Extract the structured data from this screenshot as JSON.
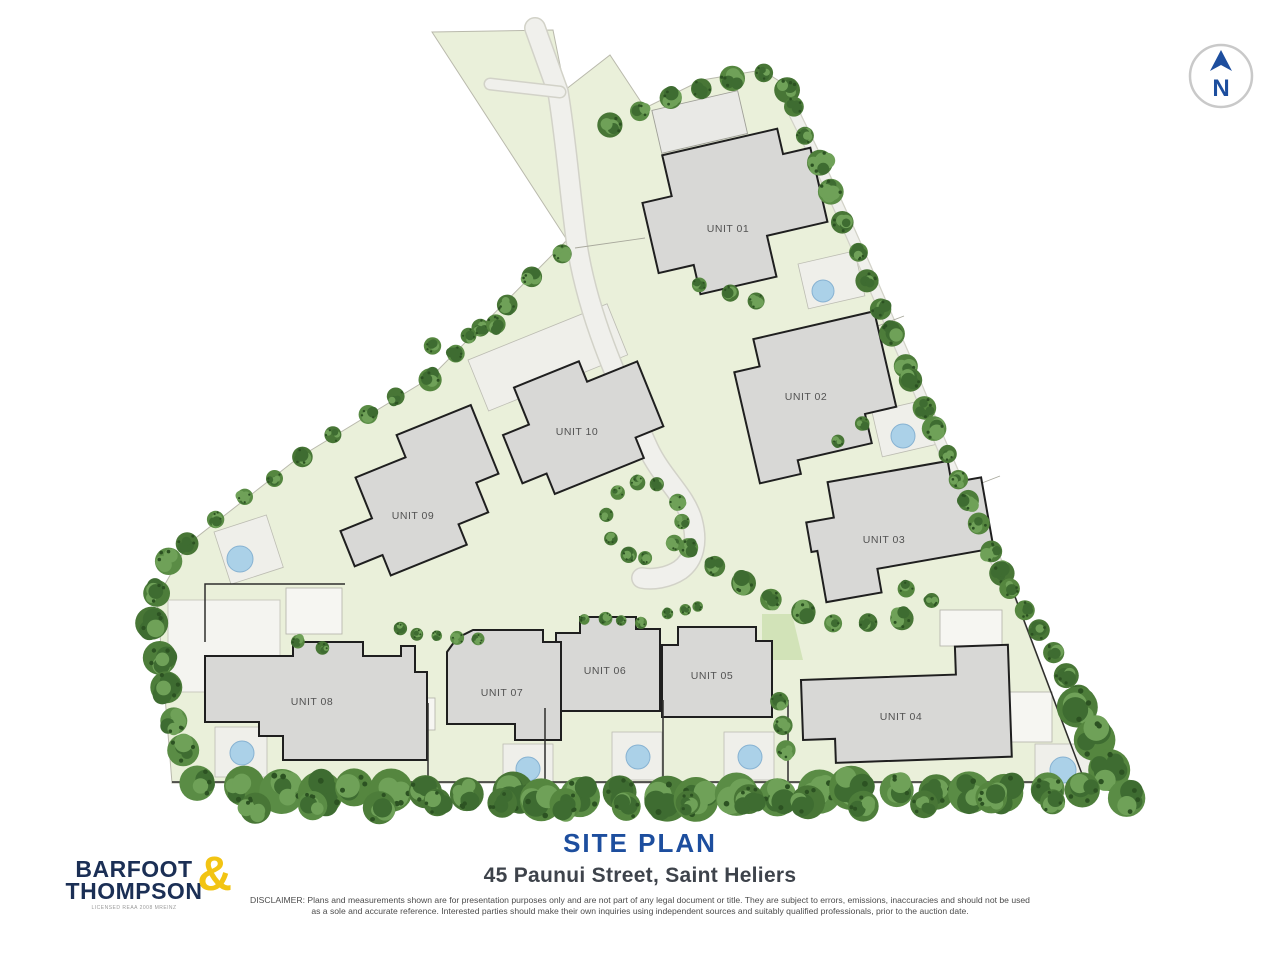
{
  "plan": {
    "title": "SITE PLAN",
    "address": "45 Paunui Street, Saint Heliers",
    "disclaimer": {
      "line1": "DISCLAIMER: Plans and measurements shown are for presentation purposes only and are not part of any legal document or title. They are subject to errors, emissions, inaccuracies and should not be used",
      "line2": "as a sole and accurate reference. Interested parties should make their own inquiries using independent sources and suitably qualified professionals, prior to the auction date."
    },
    "units": [
      {
        "label": "UNIT 01"
      },
      {
        "label": "UNIT 02"
      },
      {
        "label": "UNIT 03"
      },
      {
        "label": "UNIT 04"
      },
      {
        "label": "UNIT 05"
      },
      {
        "label": "UNIT 06"
      },
      {
        "label": "UNIT 07"
      },
      {
        "label": "UNIT 08"
      },
      {
        "label": "UNIT 09"
      },
      {
        "label": "UNIT 10"
      }
    ],
    "compass": {
      "label": "N"
    },
    "logo": {
      "word1": "BARFOOT",
      "word2": "THOMPSON",
      "ampersand": "&",
      "tagline": "LICENSED REAA 2008 MRElNZ"
    },
    "colors": {
      "accent_blue": "#1d4e9e",
      "site_green": "#eaf0da",
      "building_gray": "#d8d8d6",
      "tree_green": "#55863f",
      "pool_blue": "#abd1e8",
      "logo_navy": "#1b2f55",
      "logo_yellow": "#f2c413"
    }
  }
}
